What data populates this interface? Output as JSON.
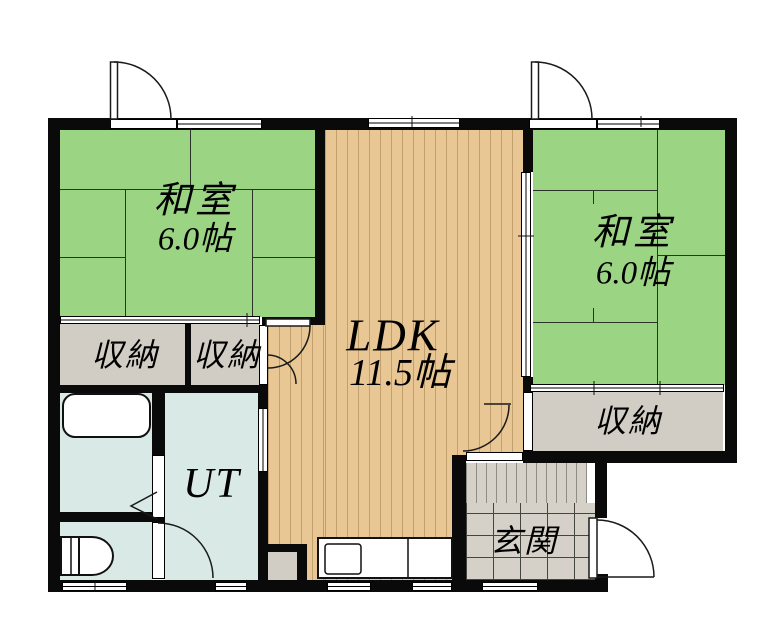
{
  "rooms": {
    "washitsu_left": {
      "name": "和室",
      "size": "6.0帖"
    },
    "washitsu_right": {
      "name": "和室",
      "size": "6.0帖"
    },
    "ldk": {
      "name": "LDK",
      "size": "11.5帖"
    },
    "storage_left": {
      "label": "収納"
    },
    "storage_mid": {
      "label": "収納"
    },
    "storage_right": {
      "label": "収納"
    },
    "utility": {
      "label": "UT"
    },
    "genkan": {
      "label": "玄関"
    }
  },
  "colors": {
    "tatami_green": "#9bd583",
    "wood_floor_tan": "#e9c795",
    "wood_stripe": "#c2a06d",
    "storage_gray": "#d1cdc4",
    "wet_area_blue": "#d9e9e6",
    "tile_gray": "#d5d1c8",
    "wall_black": "#0a0a0a"
  }
}
